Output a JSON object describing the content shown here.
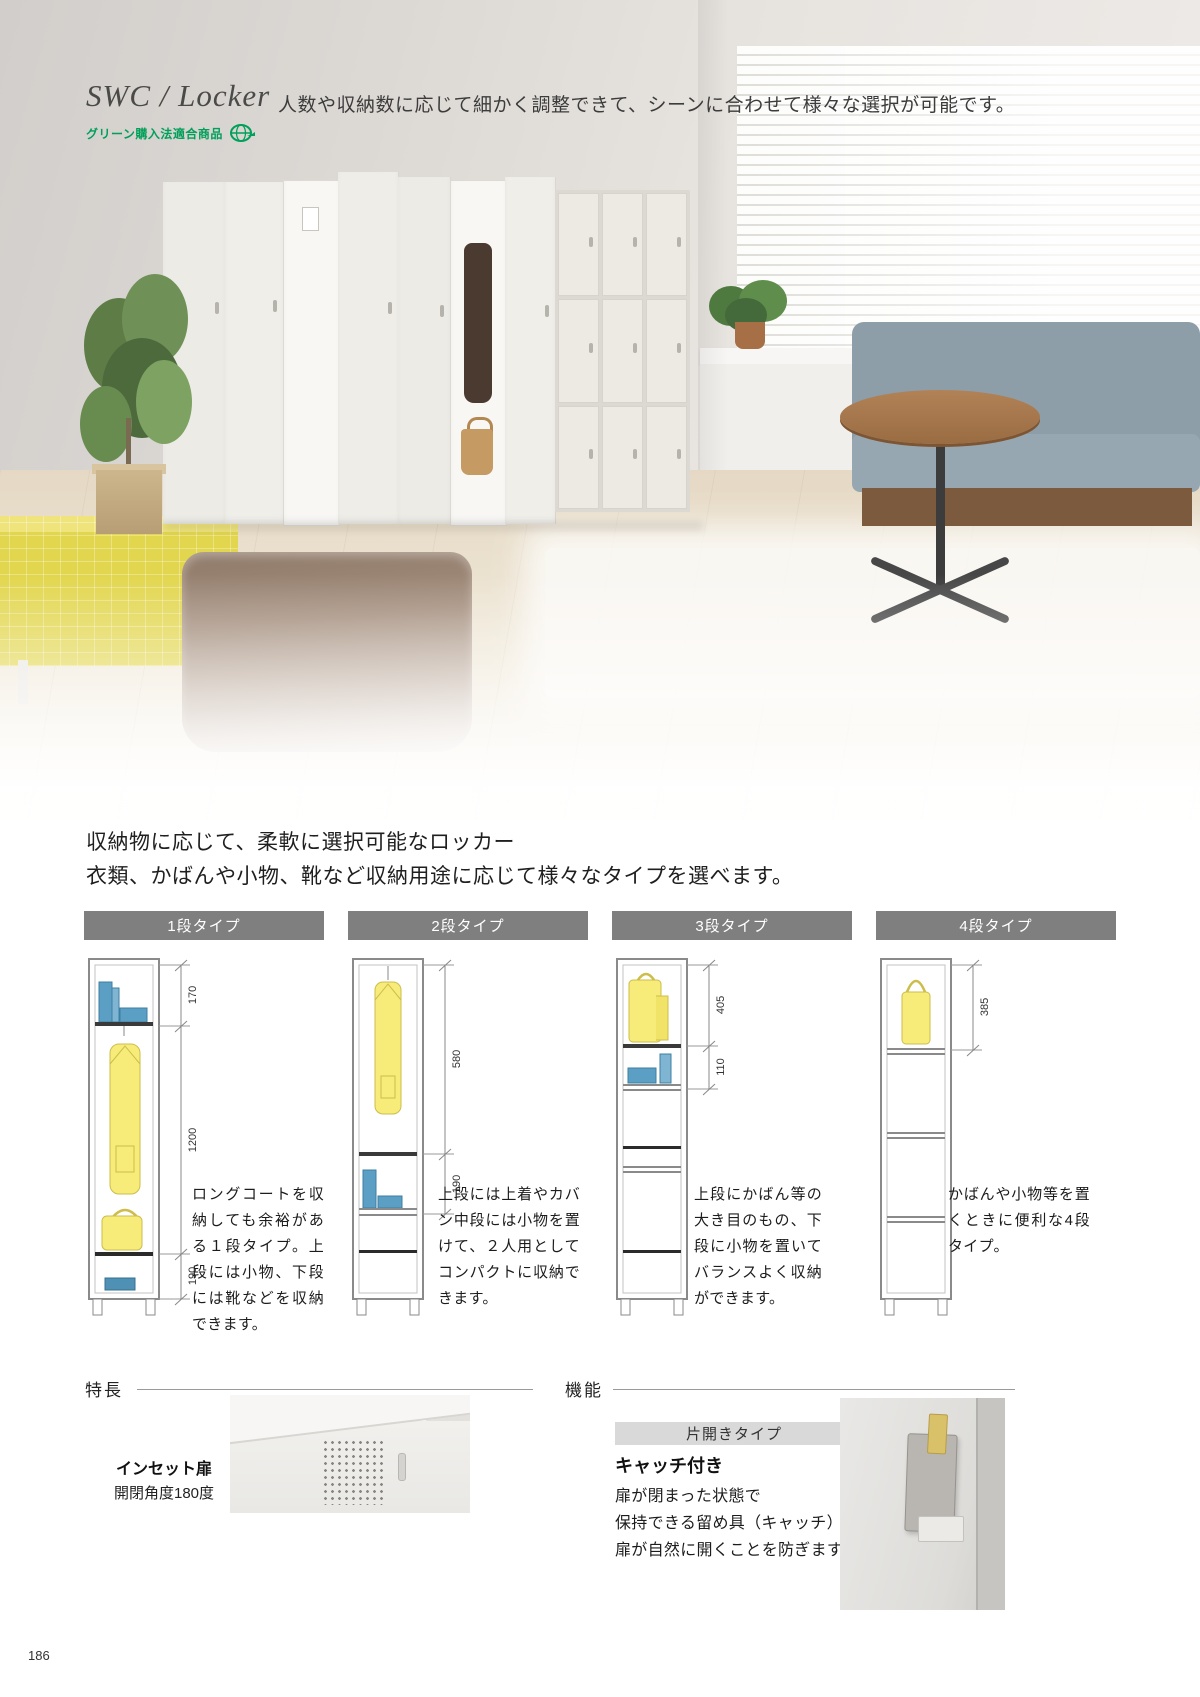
{
  "page_number": "186",
  "header": {
    "title": "SWC / Locker",
    "subtitle": "人数や収納数に応じて細かく調整できて、シーンに合わせて様々な選択が可能です。",
    "green_badge": "グリーン購入法適合商品"
  },
  "colors": {
    "green_accent": "#00a05a",
    "type_header_bg": "#7f7f7f",
    "diagram_yellow": "#f7ec7a",
    "diagram_blue": "#5b9fc4"
  },
  "intro": {
    "line1": "収納物に応じて、柔軟に選択可能なロッカー",
    "line2": "衣類、かばんや小物、靴など収納用途に応じて様々なタイプを選べます。"
  },
  "types": [
    {
      "label": "1段タイプ",
      "dim_top": "170",
      "dim_mid": "1200",
      "dim_bottom": "190",
      "desc": "ロングコートを収納しても余裕がある１段タイプ。上段には小物、下段には靴などを収納できます。"
    },
    {
      "label": "2段タイプ",
      "dim_top": "580",
      "dim_mid": "190",
      "desc": "上段には上着やカバン中段には小物を置けて、２人用としてコンパクトに収納できます。"
    },
    {
      "label": "3段タイプ",
      "dim_top": "405",
      "dim_mid": "110",
      "desc": "上段にかばん等の大き目のもの、下段に小物を置いてバランスよく収納ができます。"
    },
    {
      "label": "4段タイプ",
      "dim_top": "385",
      "desc": "かばんや小物等を置くときに便利な4段タイプ。"
    }
  ],
  "features": {
    "heading": "特長",
    "caption_title": "インセット扉",
    "caption_sub": "開閉角度180度"
  },
  "functions": {
    "heading": "機能",
    "tag": "片開きタイプ",
    "title": "キャッチ付き",
    "line1": "扉が閉まった状態で",
    "line2": "保持できる留め具（キャッチ）付き。",
    "line3": "扉が自然に開くことを防ぎます。"
  }
}
